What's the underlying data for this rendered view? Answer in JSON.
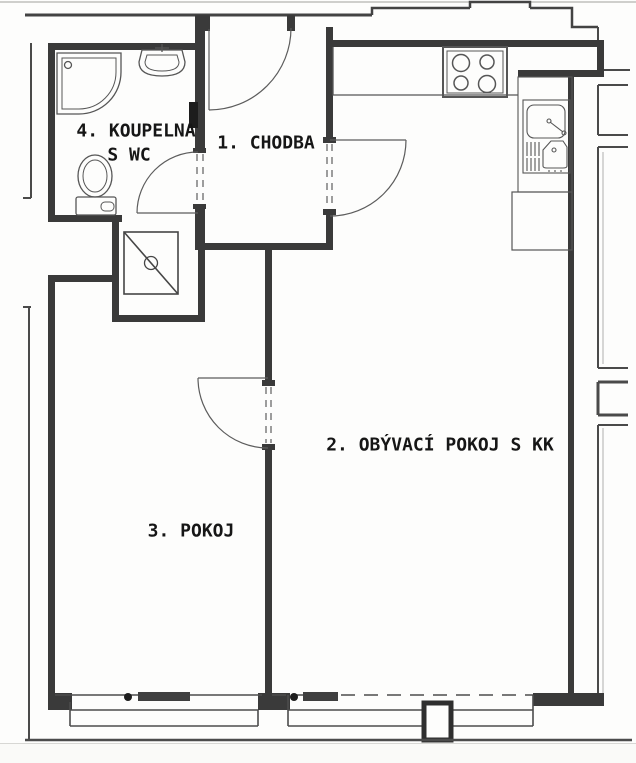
{
  "document": {
    "type": "apartment-floor-plan",
    "language": "cs"
  },
  "rooms": [
    {
      "id": "chodba",
      "label": "1. CHODBA"
    },
    {
      "id": "obyvaci-pokoj",
      "label": "2. OBÝVACÍ POKOJ S KK"
    },
    {
      "id": "pokoj",
      "label": "3. POKOJ"
    },
    {
      "id": "koupelna",
      "label_line1": "4. KOUPELNA",
      "label_line2": "S WC"
    }
  ],
  "fixtures": [
    "shower",
    "washbasin",
    "toilet",
    "installation-shaft",
    "stove-4-burners",
    "kitchen-sink",
    "kitchen-counter",
    "kitchen-cabinet",
    "radiator-room3",
    "radiator-room2",
    "window-room3",
    "window-room2-left",
    "window-room2-right"
  ],
  "doors": [
    "entrance-door",
    "bathroom-door",
    "hallway-living-door",
    "room3-door"
  ],
  "colors": {
    "wall": "#3a3a3a",
    "thin_line": "#4c4c4c",
    "fixture_line": "#565656",
    "dark_fill": "#2a2a2a",
    "background": "#fdfdfc"
  }
}
